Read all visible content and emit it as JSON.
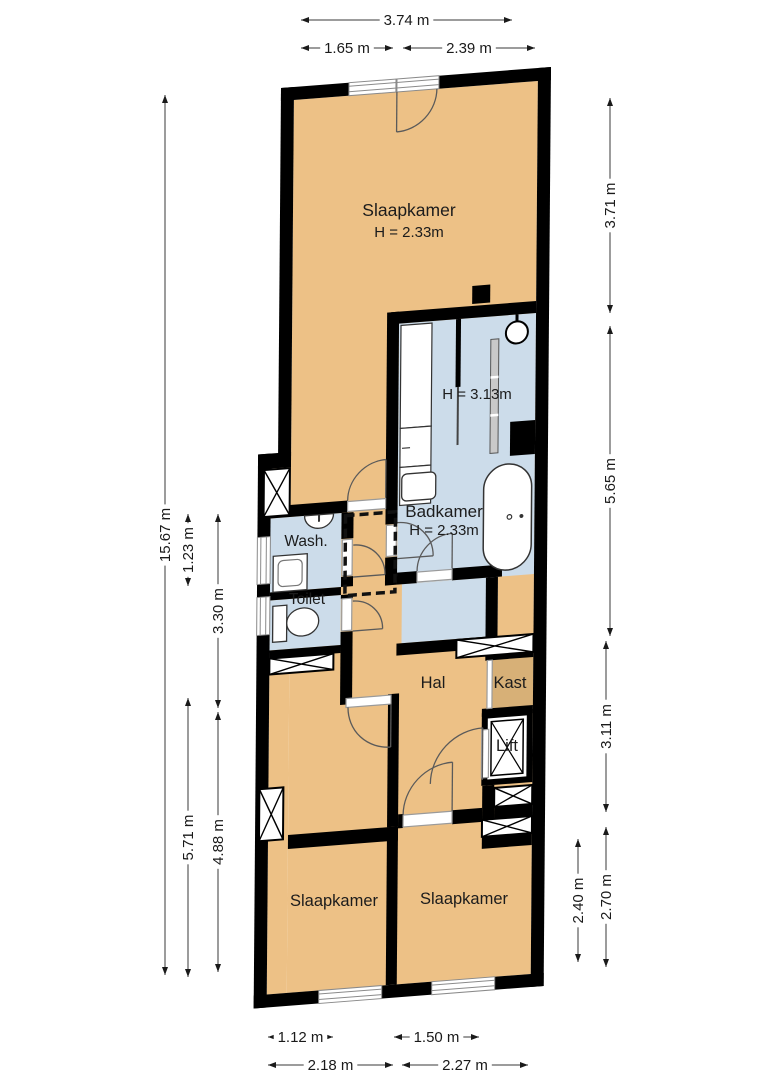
{
  "plan_type": "floor-plan",
  "colors": {
    "wall": "#000000",
    "room_orange": "#edc186",
    "room_blue": "#ccdcea",
    "kast_tan": "#d7b077",
    "dim_line": "#3a3a3a",
    "dim_text": "#1a1a1a",
    "label_text": "#1c1c1c"
  },
  "rooms": [
    {
      "name": "slaapkamer-top",
      "label": "Slaapkamer",
      "height_label": "H = 2.33m",
      "x": 409,
      "y": 216,
      "size": 17.5,
      "sub_dy": 21
    },
    {
      "name": "badkamer",
      "label": "Badkamer",
      "height_label": "H = 2.33m",
      "x": 444,
      "y": 517,
      "size": 17,
      "sub_dy": 18
    },
    {
      "name": "badkamer-shower-height",
      "label": "H = 3.13m",
      "x": 477,
      "y": 399,
      "size": 15
    },
    {
      "name": "wash",
      "label": "Wash.",
      "x": 306,
      "y": 546,
      "size": 15.5
    },
    {
      "name": "toilet",
      "label": "Toilet",
      "x": 307,
      "y": 604,
      "size": 15.5
    },
    {
      "name": "hal",
      "label": "Hal",
      "x": 433,
      "y": 688,
      "size": 16.5
    },
    {
      "name": "kast",
      "label": "Kast",
      "x": 510,
      "y": 688,
      "size": 16.5
    },
    {
      "name": "lift",
      "label": "Lift",
      "x": 507,
      "y": 751,
      "size": 16.5
    },
    {
      "name": "slaapkamer-left",
      "label": "Slaapkamer",
      "x": 334,
      "y": 906,
      "size": 16.5
    },
    {
      "name": "slaapkamer-right",
      "label": "Slaapkamer",
      "x": 464,
      "y": 904,
      "size": 16.5
    }
  ],
  "dimensions": [
    {
      "label": "3.74 m",
      "orient": "h",
      "y": 20,
      "x1": 301,
      "x2": 512
    },
    {
      "label": "1.65 m",
      "orient": "h",
      "y": 48,
      "x1": 301,
      "x2": 393
    },
    {
      "label": "2.39 m",
      "orient": "h",
      "y": 48,
      "x1": 403,
      "x2": 535
    },
    {
      "label": "15.67 m",
      "orient": "v",
      "x": 165,
      "y1": 95,
      "y2": 975
    },
    {
      "label": "1.23 m",
      "orient": "v",
      "x": 188,
      "y1": 514,
      "y2": 586
    },
    {
      "label": "3.30 m",
      "orient": "v",
      "x": 218,
      "y1": 514,
      "y2": 708
    },
    {
      "label": "5.71 m",
      "orient": "v",
      "x": 188,
      "y1": 698,
      "y2": 977
    },
    {
      "label": "4.88 m",
      "orient": "v",
      "x": 218,
      "y1": 712,
      "y2": 972
    },
    {
      "label": "3.71 m",
      "orient": "v",
      "x": 610,
      "y1": 98,
      "y2": 313
    },
    {
      "label": "5.65 m",
      "orient": "v",
      "x": 610,
      "y1": 326,
      "y2": 636
    },
    {
      "label": "3.11 m",
      "orient": "v",
      "x": 606,
      "y1": 641,
      "y2": 812
    },
    {
      "label": "2.70 m",
      "orient": "v",
      "x": 606,
      "y1": 827,
      "y2": 967
    },
    {
      "label": "2.40 m",
      "orient": "v",
      "x": 578,
      "y1": 839,
      "y2": 962
    },
    {
      "label": "1.12 m",
      "orient": "h",
      "y": 1037,
      "x1": 268,
      "x2": 333
    },
    {
      "label": "1.50 m",
      "orient": "h",
      "y": 1037,
      "x1": 394,
      "x2": 479
    },
    {
      "label": "2.18 m",
      "orient": "h",
      "y": 1065,
      "x1": 268,
      "x2": 393
    },
    {
      "label": "2.27 m",
      "orient": "h",
      "y": 1065,
      "x1": 402,
      "x2": 528
    }
  ]
}
